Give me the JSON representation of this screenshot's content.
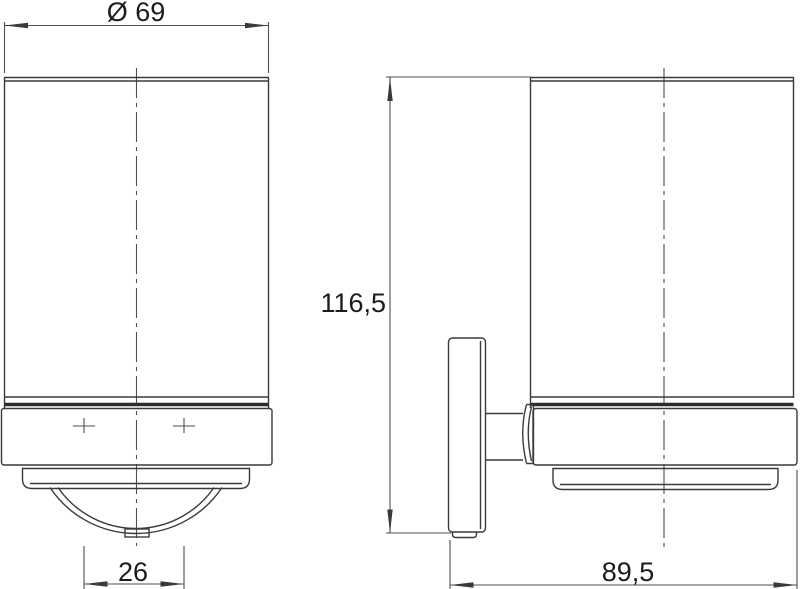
{
  "dimensions": {
    "diameter": "Ø 69",
    "height": "116,5",
    "hole_spacing": "26",
    "depth": "89,5"
  },
  "colors": {
    "background": "#ffffff",
    "outline": "#3a3a3a",
    "thick_line": "#2d2d2d",
    "dimension_line": "#4f4f4f",
    "text": "#1c1c1c"
  }
}
